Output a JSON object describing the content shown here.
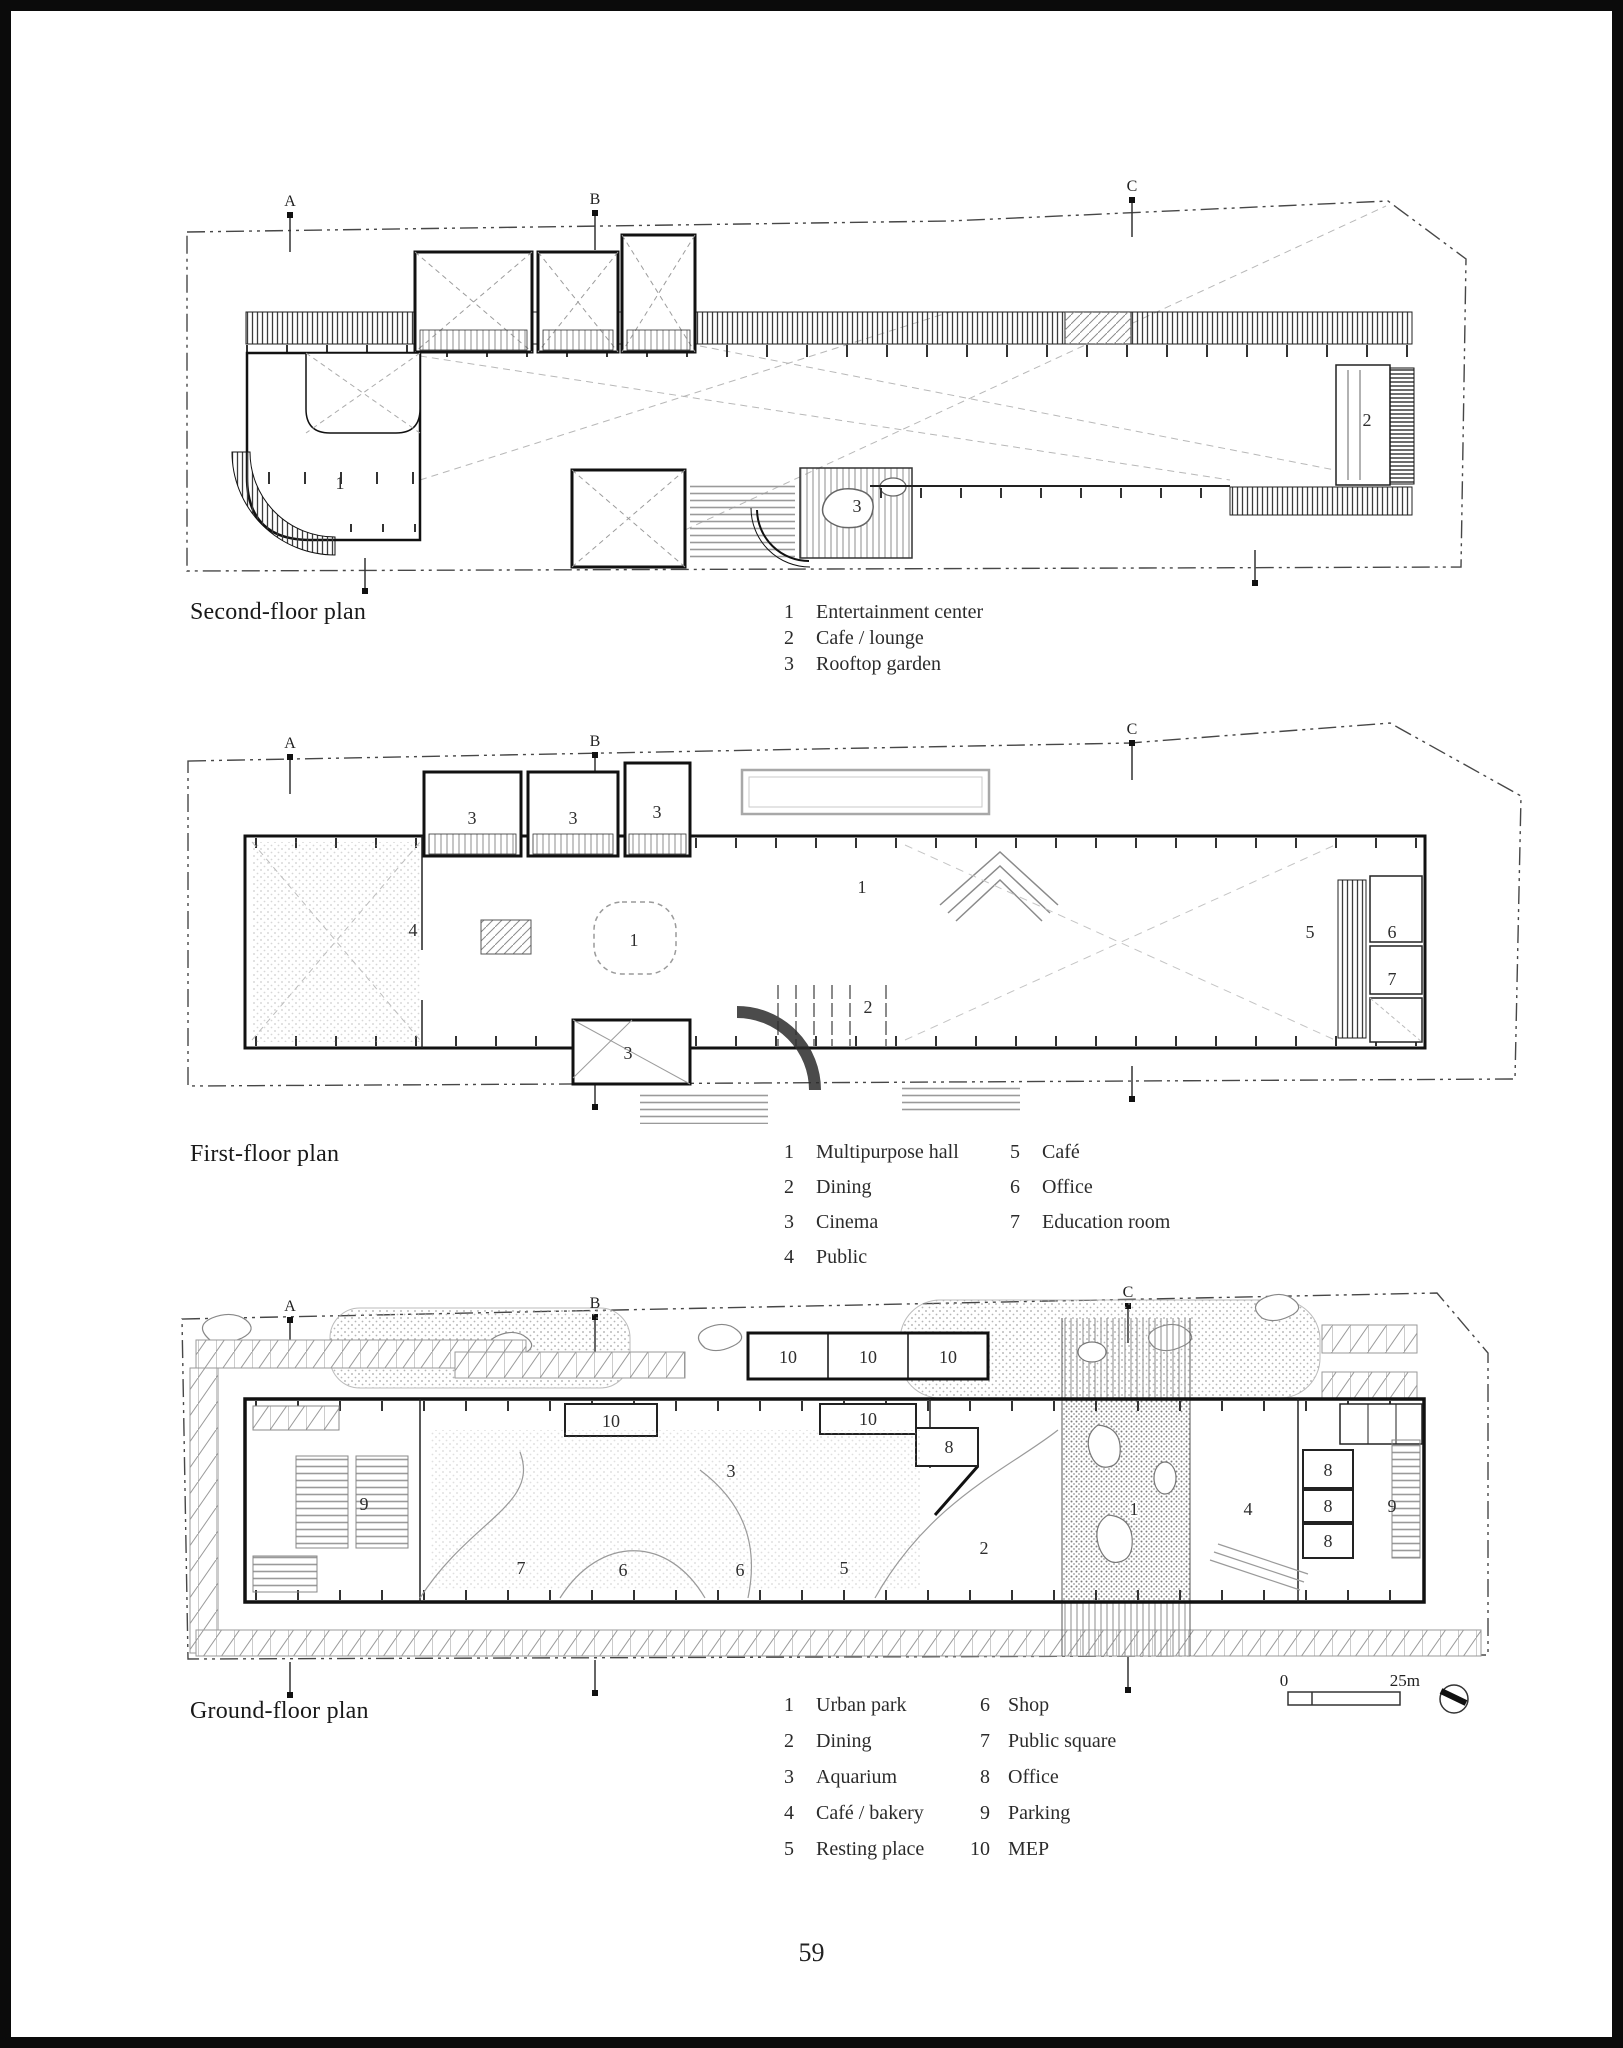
{
  "page_number": "59",
  "scalebar": {
    "zero": "0",
    "max": "25m"
  },
  "plans": [
    {
      "id": "second-floor",
      "title": "Second-floor plan",
      "grid_letters": [
        {
          "t": "A",
          "x": 290,
          "y": 206
        },
        {
          "t": "B",
          "x": 595,
          "y": 204
        },
        {
          "t": "C",
          "x": 1132,
          "y": 191
        }
      ],
      "room_labels": [
        {
          "t": "1",
          "x": 340,
          "y": 483
        },
        {
          "t": "2",
          "x": 1367,
          "y": 420
        },
        {
          "t": "3",
          "x": 857,
          "y": 506
        }
      ],
      "legend": {
        "columns": [
          [
            {
              "n": "1",
              "label": "Entertainment center"
            },
            {
              "n": "2",
              "label": "Cafe / lounge"
            },
            {
              "n": "3",
              "label": "Rooftop garden"
            }
          ]
        ]
      }
    },
    {
      "id": "first-floor",
      "title": "First-floor plan",
      "grid_letters": [
        {
          "t": "A",
          "x": 290,
          "y": 748
        },
        {
          "t": "B",
          "x": 595,
          "y": 746
        },
        {
          "t": "C",
          "x": 1132,
          "y": 734
        }
      ],
      "room_labels": [
        {
          "t": "3",
          "x": 472,
          "y": 818
        },
        {
          "t": "3",
          "x": 573,
          "y": 818
        },
        {
          "t": "3",
          "x": 657,
          "y": 812
        },
        {
          "t": "4",
          "x": 413,
          "y": 930
        },
        {
          "t": "1",
          "x": 634,
          "y": 940
        },
        {
          "t": "1",
          "x": 862,
          "y": 887
        },
        {
          "t": "2",
          "x": 868,
          "y": 1007
        },
        {
          "t": "3",
          "x": 628,
          "y": 1053
        },
        {
          "t": "5",
          "x": 1310,
          "y": 932
        },
        {
          "t": "6",
          "x": 1392,
          "y": 932
        },
        {
          "t": "7",
          "x": 1392,
          "y": 979
        }
      ],
      "legend": {
        "columns": [
          [
            {
              "n": "1",
              "label": "Multipurpose hall"
            },
            {
              "n": "2",
              "label": "Dining"
            },
            {
              "n": "3",
              "label": "Cinema"
            },
            {
              "n": "4",
              "label": "Public"
            }
          ],
          [
            {
              "n": "5",
              "label": "Café"
            },
            {
              "n": "6",
              "label": "Office"
            },
            {
              "n": "7",
              "label": "Education room"
            }
          ]
        ]
      }
    },
    {
      "id": "ground-floor",
      "title": "Ground-floor plan",
      "grid_letters": [
        {
          "t": "A",
          "x": 290,
          "y": 1311
        },
        {
          "t": "B",
          "x": 595,
          "y": 1308
        },
        {
          "t": "C",
          "x": 1128,
          "y": 1297
        }
      ],
      "room_labels": [
        {
          "t": "10",
          "x": 788,
          "y": 1357
        },
        {
          "t": "10",
          "x": 868,
          "y": 1357
        },
        {
          "t": "10",
          "x": 948,
          "y": 1357
        },
        {
          "t": "10",
          "x": 611,
          "y": 1421
        },
        {
          "t": "10",
          "x": 868,
          "y": 1419
        },
        {
          "t": "8",
          "x": 949,
          "y": 1447
        },
        {
          "t": "3",
          "x": 731,
          "y": 1471
        },
        {
          "t": "9",
          "x": 364,
          "y": 1504
        },
        {
          "t": "1",
          "x": 1134,
          "y": 1509,
          "halo": true
        },
        {
          "t": "4",
          "x": 1248,
          "y": 1509
        },
        {
          "t": "8",
          "x": 1328,
          "y": 1470
        },
        {
          "t": "8",
          "x": 1328,
          "y": 1506
        },
        {
          "t": "8",
          "x": 1328,
          "y": 1541
        },
        {
          "t": "9",
          "x": 1392,
          "y": 1506
        },
        {
          "t": "7",
          "x": 521,
          "y": 1568
        },
        {
          "t": "6",
          "x": 623,
          "y": 1570
        },
        {
          "t": "6",
          "x": 740,
          "y": 1570
        },
        {
          "t": "5",
          "x": 844,
          "y": 1568
        },
        {
          "t": "2",
          "x": 984,
          "y": 1548
        }
      ],
      "legend": {
        "columns": [
          [
            {
              "n": "1",
              "label": "Urban park"
            },
            {
              "n": "2",
              "label": "Dining"
            },
            {
              "n": "3",
              "label": "Aquarium"
            },
            {
              "n": "4",
              "label": "Café / bakery"
            },
            {
              "n": "5",
              "label": "Resting place"
            }
          ],
          [
            {
              "n": "6",
              "label": "Shop"
            },
            {
              "n": "7",
              "label": "Public square"
            },
            {
              "n": "8",
              "label": "Office"
            },
            {
              "n": "9",
              "label": "Parking"
            },
            {
              "n": "10",
              "label": "MEP"
            }
          ]
        ]
      }
    }
  ]
}
